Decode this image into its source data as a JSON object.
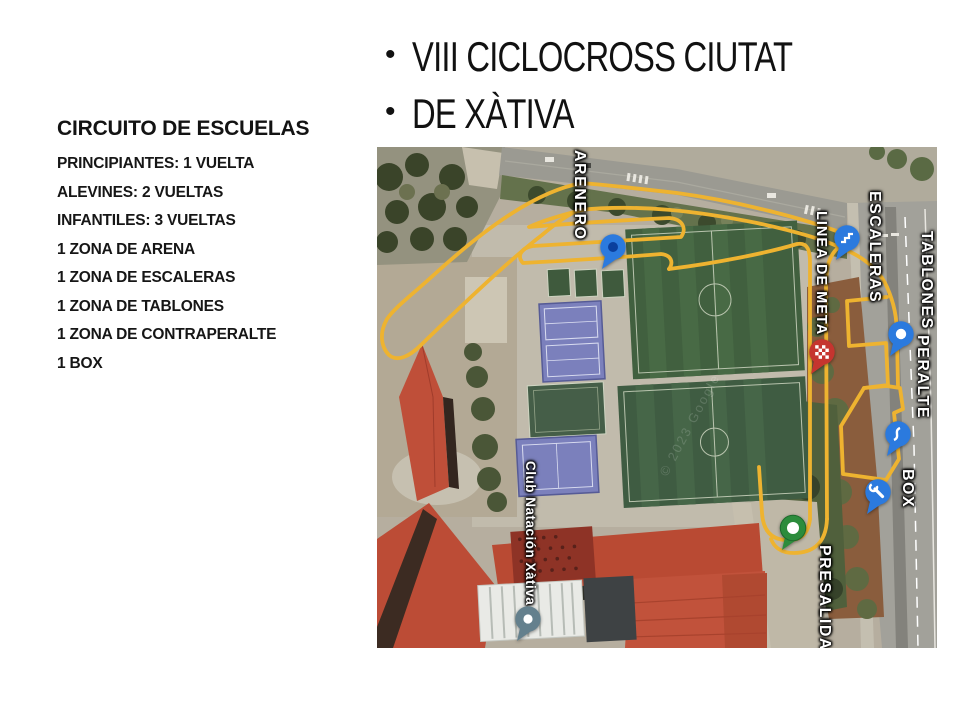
{
  "slide": {
    "bullet_char": "•",
    "title_lines": [
      "VIII CICLOCROSS CIUTAT",
      "DE XÀTIVA"
    ],
    "left_panel": {
      "heading": "CIRCUITO DE ESCUELAS",
      "items": [
        "PRINCIPIANTES: 1 VUELTA",
        "ALEVINES: 2 VUELTAS",
        "INFANTILES: 3 VUELTAS",
        "1 ZONA DE ARENA",
        "1 ZONA DE ESCALERAS",
        "1 ZONA DE TABLONES",
        "1 ZONA DE CONTRAPERALTE",
        "1 BOX"
      ]
    }
  },
  "map": {
    "watermark": "© 2023 Google",
    "labels": [
      {
        "text": "ARENERO"
      },
      {
        "text": "LINEA DE META"
      },
      {
        "text": "ESCALERAS"
      },
      {
        "text": "TABLONES"
      },
      {
        "text": "PERALTE"
      },
      {
        "text": "BOX"
      },
      {
        "text": "PRESALIDA"
      },
      {
        "text": "Club Natación Xàtiva"
      }
    ],
    "pins": [
      {
        "name": "arenero-pin",
        "glyph": "dot-dark",
        "color": "#2b7ade"
      },
      {
        "name": "escaleras-pin",
        "glyph": "stairs",
        "color": "#2b7ade"
      },
      {
        "name": "tablones-pin",
        "glyph": "dot-white",
        "color": "#2b7ade"
      },
      {
        "name": "linea-de-meta-pin",
        "glyph": "checkered-flag",
        "color": "#c5352f"
      },
      {
        "name": "peralte-pin",
        "glyph": "berm-curve",
        "color": "#2b7ade"
      },
      {
        "name": "box-pin",
        "glyph": "wrench",
        "color": "#2b7ade"
      },
      {
        "name": "presalida-pin",
        "glyph": "start-circle",
        "color": "#2c8c3c"
      },
      {
        "name": "club-natacion-pin",
        "glyph": "dot-white",
        "color": "#64808d"
      }
    ],
    "colors": {
      "route": "#eeb330",
      "field_green": "#41603f",
      "court_blue": "#7b80bc",
      "roof_red": "#bf4f39"
    }
  }
}
